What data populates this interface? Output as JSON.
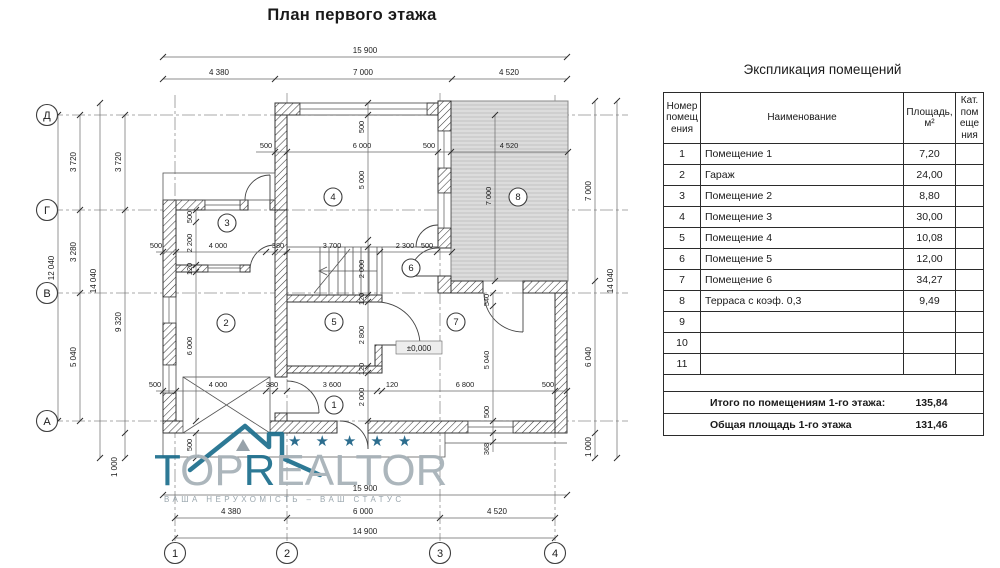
{
  "plan": {
    "title": "План первого этажа",
    "level_mark": "±0,000",
    "axes": {
      "rows": [
        "Д",
        "Г",
        "В",
        "А"
      ],
      "cols": [
        "1",
        "2",
        "3",
        "4"
      ]
    },
    "rooms": [
      "1",
      "2",
      "3",
      "4",
      "5",
      "6",
      "7",
      "8"
    ],
    "dims": {
      "d15900": "15 900",
      "d14900": "14 900",
      "d14040": "14 040",
      "d12040": "12 040",
      "d9320": "9 320",
      "d7000": "7 000",
      "d6800": "6 800",
      "d6040": "6 040",
      "d6000": "6 000",
      "d5040": "5 040",
      "d5000": "5 000",
      "d4520": "4 520",
      "d4380": "4 380",
      "d4000": "4 000",
      "d3720": "3 720",
      "d3700": "3 700",
      "d3600": "3 600",
      "d3280": "3 280",
      "d2800": "2 800",
      "d2300": "2 300",
      "d2200": "2 200",
      "d2000": "2 000",
      "d1000": "1 000",
      "d540": "540",
      "d500": "500",
      "d380": "380",
      "d368": "368",
      "d120": "120"
    }
  },
  "table": {
    "title": "Экспликация помещений",
    "headers": {
      "number": "Номер помещения",
      "name": "Наименование",
      "area": "Площадь, м²",
      "cat": "Кат. помещения"
    },
    "rows": [
      {
        "n": "1",
        "name": "Помещение 1",
        "area": "7,20"
      },
      {
        "n": "2",
        "name": "Гараж",
        "area": "24,00"
      },
      {
        "n": "3",
        "name": "Помещение 2",
        "area": "8,80"
      },
      {
        "n": "4",
        "name": "Помещение 3",
        "area": "30,00"
      },
      {
        "n": "5",
        "name": "Помещение 4",
        "area": "10,08"
      },
      {
        "n": "6",
        "name": "Помещение 5",
        "area": "12,00"
      },
      {
        "n": "7",
        "name": "Помещение 6",
        "area": "34,27"
      },
      {
        "n": "8",
        "name": "Терраса с коэф. 0,3",
        "area": "9,49"
      },
      {
        "n": "9",
        "name": "",
        "area": ""
      },
      {
        "n": "10",
        "name": "",
        "area": ""
      },
      {
        "n": "11",
        "name": "",
        "area": ""
      }
    ],
    "total_rooms_label": "Итого по помещениям 1-го этажа:",
    "total_rooms_value": "135,84",
    "total_area_label": "Общая площадь 1-го этажа",
    "total_area_value": "131,46"
  },
  "watermark": {
    "brand_parts": [
      "T",
      "OP",
      "R",
      "EALTOR"
    ],
    "star": "★",
    "tagline": "ВАША НЕРУХОМІСТЬ – ВАШ СТАТУС",
    "accent_color": "#1e6f8e"
  }
}
